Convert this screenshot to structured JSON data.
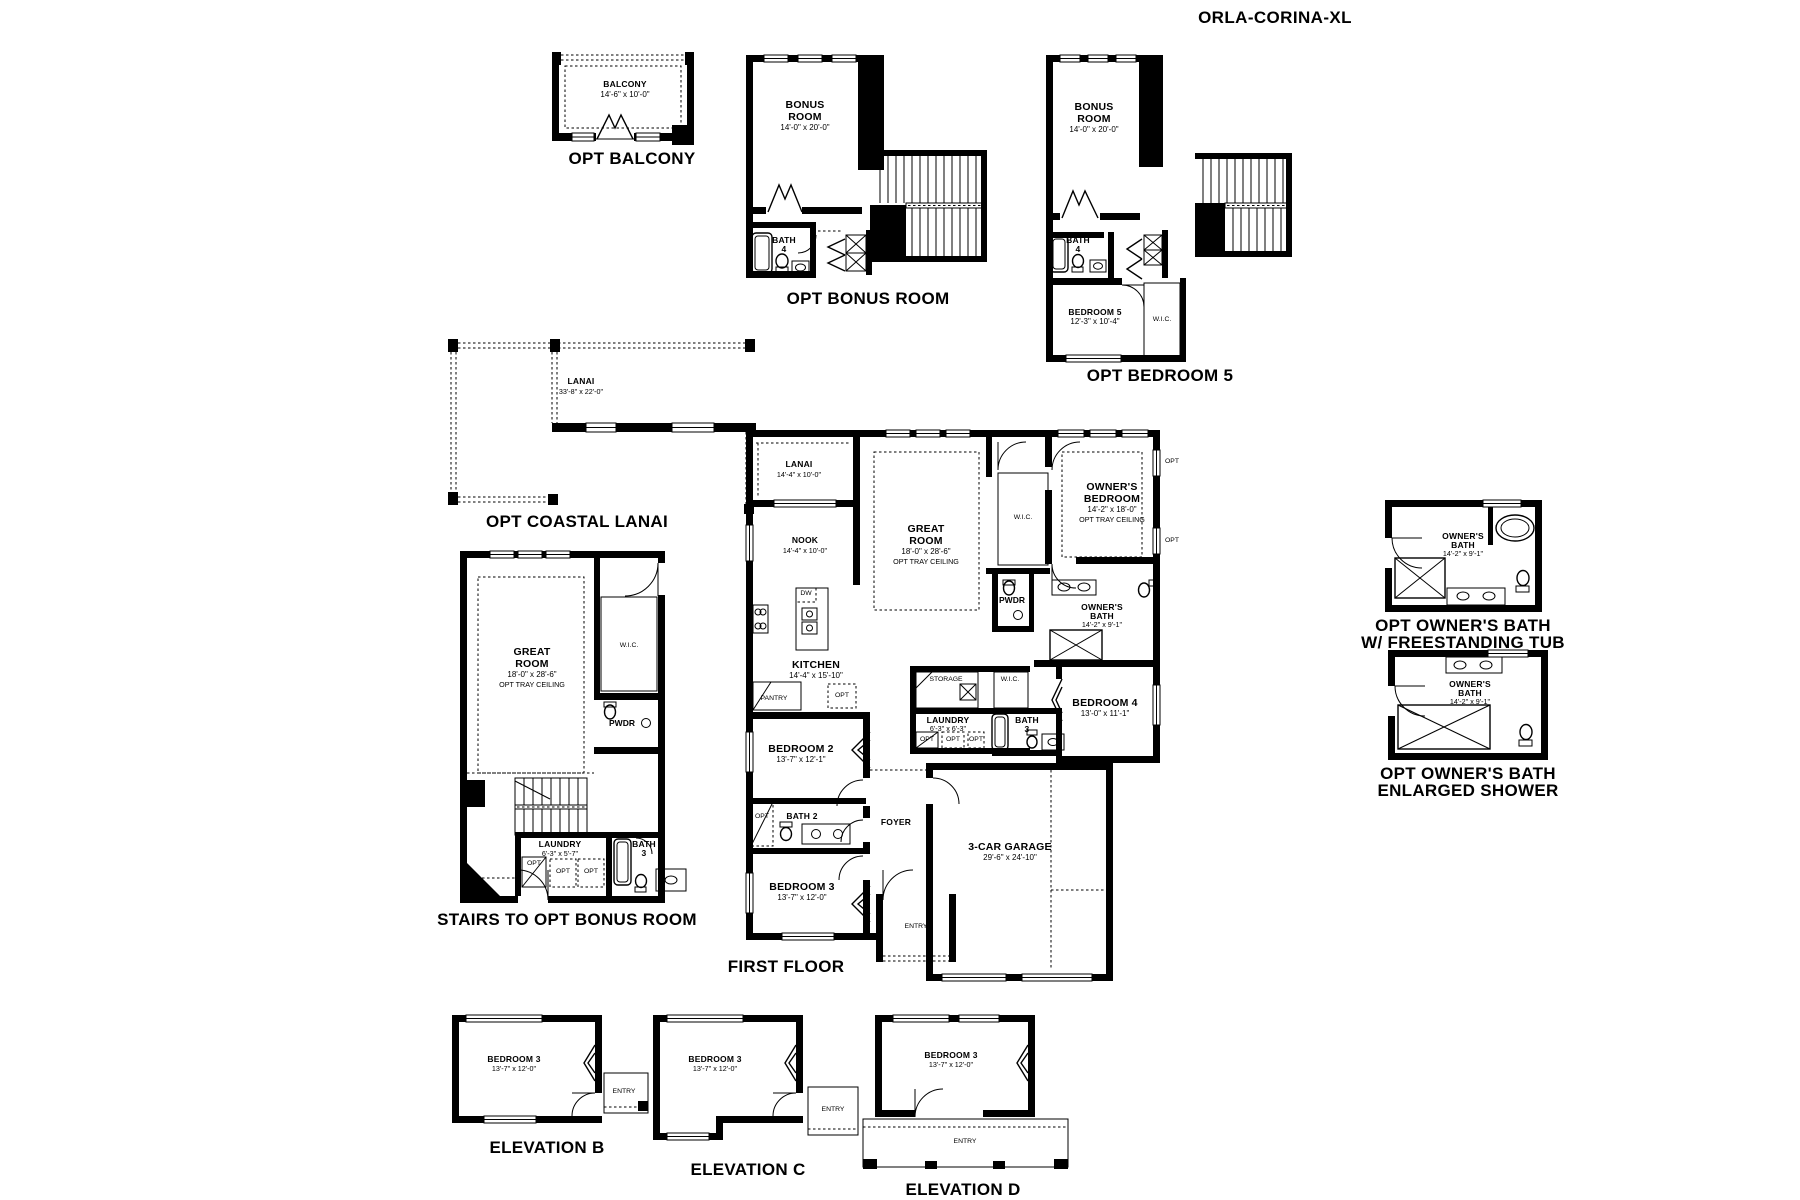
{
  "title": "ORLA-CORINA-XL",
  "captions": {
    "balcony": "OPT BALCONY",
    "bonus": "OPT BONUS ROOM",
    "bedroom5": "OPT BEDROOM 5",
    "coastal_lanai": "OPT COASTAL LANAI",
    "stairs": "STAIRS TO OPT BONUS ROOM",
    "first_floor": "FIRST FLOOR",
    "bath_tub_l1": "OPT OWNER'S BATH",
    "bath_tub_l2": "W/ FREESTANDING TUB",
    "bath_shower_l1": "OPT OWNER'S BATH",
    "bath_shower_l2": "ENLARGED SHOWER",
    "elev_b": "ELEVATION B",
    "elev_c": "ELEVATION C",
    "elev_d": "ELEVATION D"
  },
  "rooms": {
    "balcony": {
      "name": "BALCONY",
      "dims": "14'-6\" x 10'-0\""
    },
    "bonus": {
      "l1": "BONUS",
      "l2": "ROOM",
      "dims": "14'-0\" x 20'-0\""
    },
    "bath4": {
      "l1": "BATH",
      "l2": "4"
    },
    "bedroom5": {
      "name": "BEDROOM 5",
      "dims": "12'-3\" x 10'-4\""
    },
    "coastal_lanai": {
      "name": "LANAI",
      "dims": "33'-8\" x 22'-0\""
    },
    "great": {
      "l1": "GREAT",
      "l2": "ROOM",
      "dims": "18'-0\" x 28'-6\"",
      "opt": "OPT TRAY CEILING"
    },
    "laundry_stairs": {
      "name": "LAUNDRY",
      "dims": "6'-3\" x 5'-7\""
    },
    "laundry": {
      "name": "LAUNDRY",
      "dims": "6'-3\" x 6'-3\""
    },
    "bath3": {
      "l1": "BATH",
      "l2": "3"
    },
    "bath2": {
      "name": "BATH 2"
    },
    "pwdr": "PWDR",
    "wic": "W.I.C.",
    "opt": "OPT",
    "dw": "DW",
    "pantry": "PANTRY",
    "storage": "STORAGE",
    "lanai": {
      "name": "LANAI",
      "dims": "14'-4\" x 10'-0\""
    },
    "nook": {
      "name": "NOOK",
      "dims": "14'-4\" x 10'-0\""
    },
    "kitchen": {
      "name": "KITCHEN",
      "dims": "14'-4\" x 15'-10\""
    },
    "owners_bed": {
      "l1": "OWNER'S",
      "l2": "BEDROOM",
      "dims": "14'-2\" x 18'-0\"",
      "opt": "OPT TRAY CEILING"
    },
    "owners_bath": {
      "l1": "OWNER'S",
      "l2": "BATH",
      "dims": "14'-2\" x 9'-1\""
    },
    "bedroom2": {
      "name": "BEDROOM 2",
      "dims": "13'-7\" x 12'-1\""
    },
    "bedroom3": {
      "name": "BEDROOM 3",
      "dims": "13'-7\" x 12'-0\""
    },
    "bedroom4": {
      "name": "BEDROOM 4",
      "dims": "13'-0\" x 11'-1\""
    },
    "foyer": "FOYER",
    "entry": "ENTRY",
    "garage": {
      "name": "3-CAR GARAGE",
      "dims": "29'-6\" x 24'-10\""
    }
  }
}
